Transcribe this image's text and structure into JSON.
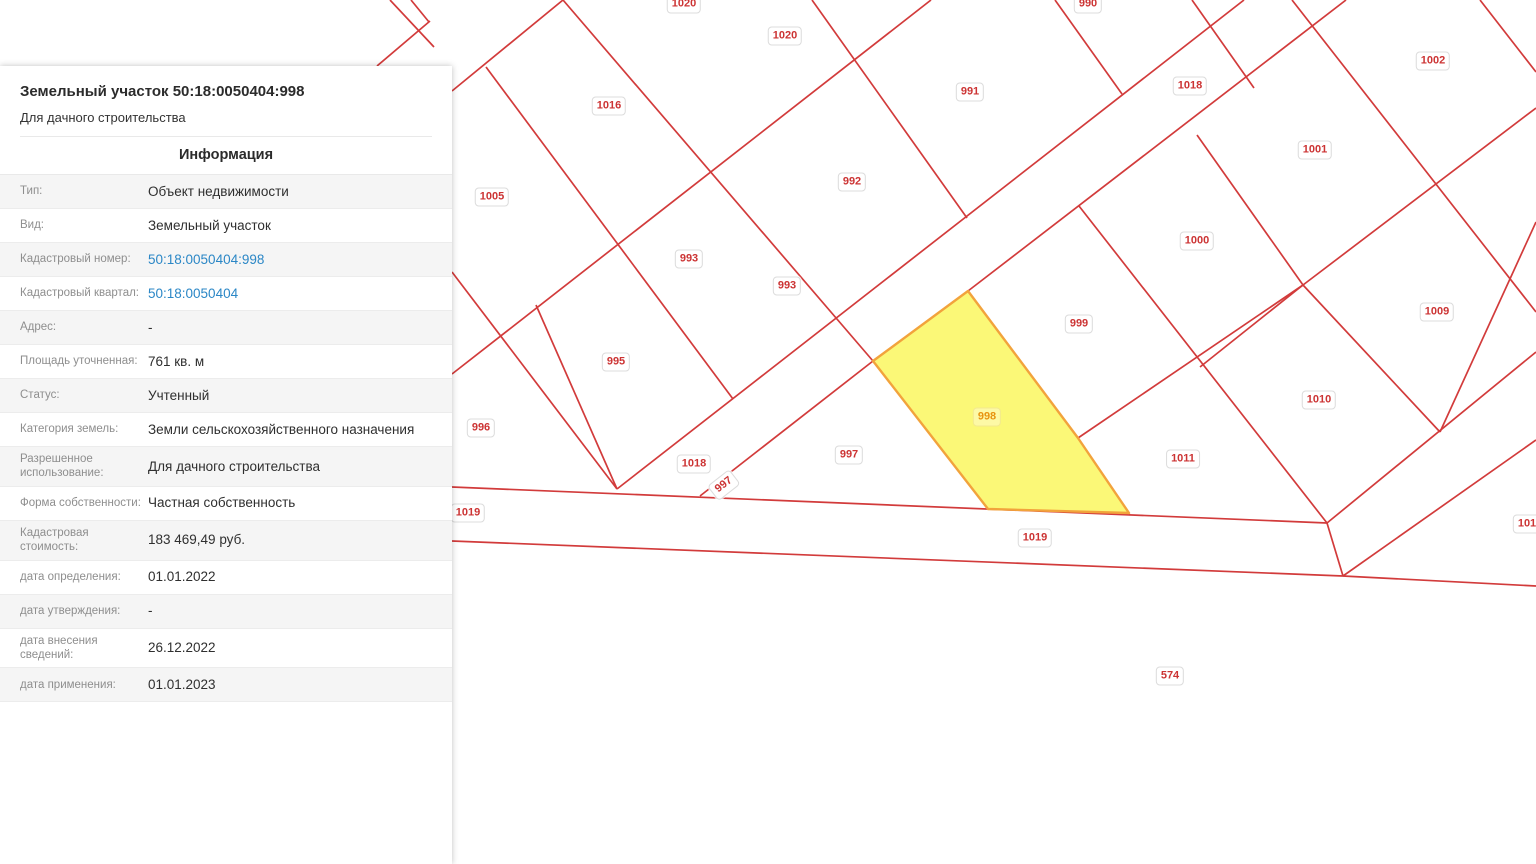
{
  "panel": {
    "title": "Земельный участок 50:18:0050404:998",
    "subtitle": "Для дачного строительства",
    "section_header": "Информация",
    "rows": [
      {
        "label": "Тип:",
        "value": "Объект недвижимости",
        "link": false
      },
      {
        "label": "Вид:",
        "value": "Земельный участок",
        "link": false
      },
      {
        "label": "Кадастровый номер:",
        "value": "50:18:0050404:998",
        "link": true
      },
      {
        "label": "Кадастровый квартал:",
        "value": "50:18:0050404",
        "link": true
      },
      {
        "label": "Адрес:",
        "value": "-",
        "link": false
      },
      {
        "label": "Площадь уточненная:",
        "value": "761 кв. м",
        "link": false
      },
      {
        "label": "Статус:",
        "value": "Учтенный",
        "link": false
      },
      {
        "label": "Категория земель:",
        "value": "Земли сельскохозяйственного назначения",
        "link": false
      },
      {
        "label": "Разрешенное использование:",
        "value": "Для дачного строительства",
        "link": false
      },
      {
        "label": "Форма собственности:",
        "value": "Частная собственность",
        "link": false
      },
      {
        "label": "Кадастровая стоимость:",
        "value": "183 469,49 руб.",
        "link": false
      },
      {
        "label": "дата определения:",
        "value": "01.01.2022",
        "link": false
      },
      {
        "label": "дата утверждения:",
        "value": "-",
        "link": false
      },
      {
        "label": "дата внесения сведений:",
        "value": "26.12.2022",
        "link": false
      },
      {
        "label": "дата применения:",
        "value": "01.01.2023",
        "link": false
      }
    ]
  },
  "map": {
    "colors": {
      "background": "#ffffff",
      "boundary_line": "#d23b3b",
      "label_text": "#cc3333",
      "selected_fill": "#fbf877",
      "selected_stroke": "#f2a33c",
      "selected_label_text": "#e8930f",
      "link_blue": "#2b87c6"
    },
    "selected_parcel": {
      "id": "998",
      "points": "968,291 1078,438 1129,513 988,509 873,361"
    },
    "labels": [
      {
        "text": "1020",
        "x": 684,
        "y": 4
      },
      {
        "text": "1020",
        "x": 785,
        "y": 36
      },
      {
        "text": "990",
        "x": 1088,
        "y": 4
      },
      {
        "text": "1002",
        "x": 1433,
        "y": 61
      },
      {
        "text": "1018",
        "x": 1190,
        "y": 86
      },
      {
        "text": "991",
        "x": 970,
        "y": 92
      },
      {
        "text": "1016",
        "x": 609,
        "y": 106
      },
      {
        "text": "1001",
        "x": 1315,
        "y": 150
      },
      {
        "text": "992",
        "x": 852,
        "y": 182
      },
      {
        "text": "1005",
        "x": 492,
        "y": 197
      },
      {
        "text": "1000",
        "x": 1197,
        "y": 241
      },
      {
        "text": "993",
        "x": 689,
        "y": 259
      },
      {
        "text": "993",
        "x": 787,
        "y": 286
      },
      {
        "text": "1009",
        "x": 1437,
        "y": 312
      },
      {
        "text": "999",
        "x": 1079,
        "y": 324
      },
      {
        "text": "995",
        "x": 616,
        "y": 362
      },
      {
        "text": "1010",
        "x": 1319,
        "y": 400
      },
      {
        "text": "998",
        "x": 987,
        "y": 417,
        "selected": true
      },
      {
        "text": "996",
        "x": 481,
        "y": 428
      },
      {
        "text": "997",
        "x": 849,
        "y": 455
      },
      {
        "text": "1011",
        "x": 1183,
        "y": 459
      },
      {
        "text": "1018",
        "x": 694,
        "y": 464
      },
      {
        "text": "997",
        "x": 724,
        "y": 485,
        "rotated": true
      },
      {
        "text": "1019",
        "x": 468,
        "y": 513
      },
      {
        "text": "101",
        "x": 1527,
        "y": 524
      },
      {
        "text": "1019",
        "x": 1035,
        "y": 538
      },
      {
        "text": "574",
        "x": 1170,
        "y": 676
      }
    ],
    "boundary_segments": [
      [
        390,
        0,
        434,
        47
      ],
      [
        411,
        0,
        429,
        22
      ],
      [
        377,
        66,
        430,
        21
      ],
      [
        452,
        91,
        563,
        0
      ],
      [
        563,
        0,
        873,
        361
      ],
      [
        486,
        67,
        733,
        399
      ],
      [
        452,
        374,
        931,
        0
      ],
      [
        452,
        272,
        617,
        489
      ],
      [
        536,
        305,
        617,
        489
      ],
      [
        812,
        0,
        967,
        218
      ],
      [
        617,
        489,
        1244,
        0
      ],
      [
        700,
        496,
        873,
        361
      ],
      [
        968,
        291,
        1346,
        0
      ],
      [
        1055,
        0,
        1122,
        94
      ],
      [
        1192,
        0,
        1254,
        88
      ],
      [
        1197,
        135,
        1303,
        285
      ],
      [
        1200,
        367,
        1303,
        285
      ],
      [
        1303,
        285,
        1440,
        432
      ],
      [
        1079,
        206,
        1327,
        523
      ],
      [
        1078,
        438,
        1303,
        285
      ],
      [
        1303,
        285,
        1536,
        108
      ],
      [
        1292,
        0,
        1536,
        312
      ],
      [
        1480,
        0,
        1536,
        72
      ],
      [
        1440,
        432,
        1536,
        222
      ],
      [
        452,
        487,
        1327,
        523
      ],
      [
        452,
        541,
        1343,
        576
      ],
      [
        1343,
        576,
        1536,
        586
      ],
      [
        1327,
        523,
        1343,
        576
      ],
      [
        1327,
        523,
        1536,
        352
      ],
      [
        1343,
        576,
        1536,
        440
      ]
    ]
  }
}
